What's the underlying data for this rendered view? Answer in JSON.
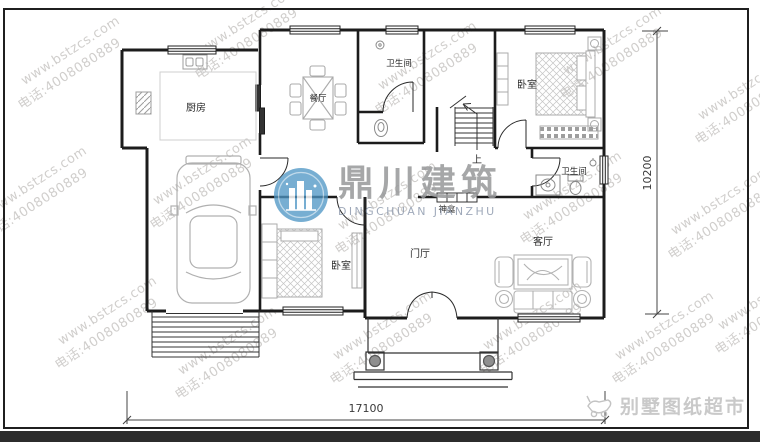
{
  "watermark": {
    "line1": "www.bstzcs.com",
    "line2": "电话:4008080889"
  },
  "logo_center": {
    "title": "鼎川建筑",
    "subtitle": "DINGCHUAN JIANZHU",
    "circle_color": "#4e96c4"
  },
  "logo_corner": {
    "text": "别墅图纸超市"
  },
  "rooms": {
    "kitchen": "厨房",
    "dining": "餐厅",
    "bath_top": "卫生间",
    "bath_mid": "卫生间",
    "bedroom_right": "卧室",
    "bedroom_left": "卧室",
    "foyer": "门厅",
    "living": "客厅",
    "stairs_up": "上",
    "shrine": "神龛"
  },
  "dimensions": {
    "width": "17100",
    "height": "10200"
  },
  "colors": {
    "wall": "#1c1c1c",
    "furniture": "#adadad",
    "fixture": "#8a8a8a",
    "watermark": "#9a9691",
    "bottom_bar": "#2c2c2c"
  }
}
